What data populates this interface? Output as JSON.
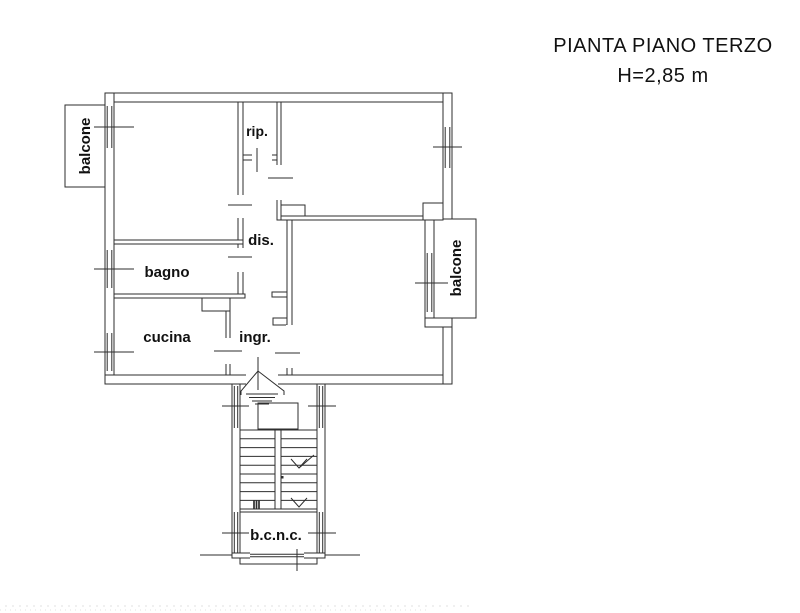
{
  "header": {
    "title": "PIANTA PIANO TERZO",
    "subtitle": "H=2,85 m"
  },
  "plan": {
    "rooms": {
      "balcone_left": {
        "label": "balcone"
      },
      "rip": {
        "label": "rip."
      },
      "dis": {
        "label": "dis."
      },
      "bagno": {
        "label": "bagno"
      },
      "cucina": {
        "label": "cucina"
      },
      "ingr": {
        "label": "ingr."
      },
      "balcone_right": {
        "label": "balcone"
      },
      "bcnc": {
        "label": "b.c.n.c."
      }
    }
  },
  "colors": {
    "line": "#2e2e2e",
    "text": "#111111",
    "background": "#ffffff"
  }
}
